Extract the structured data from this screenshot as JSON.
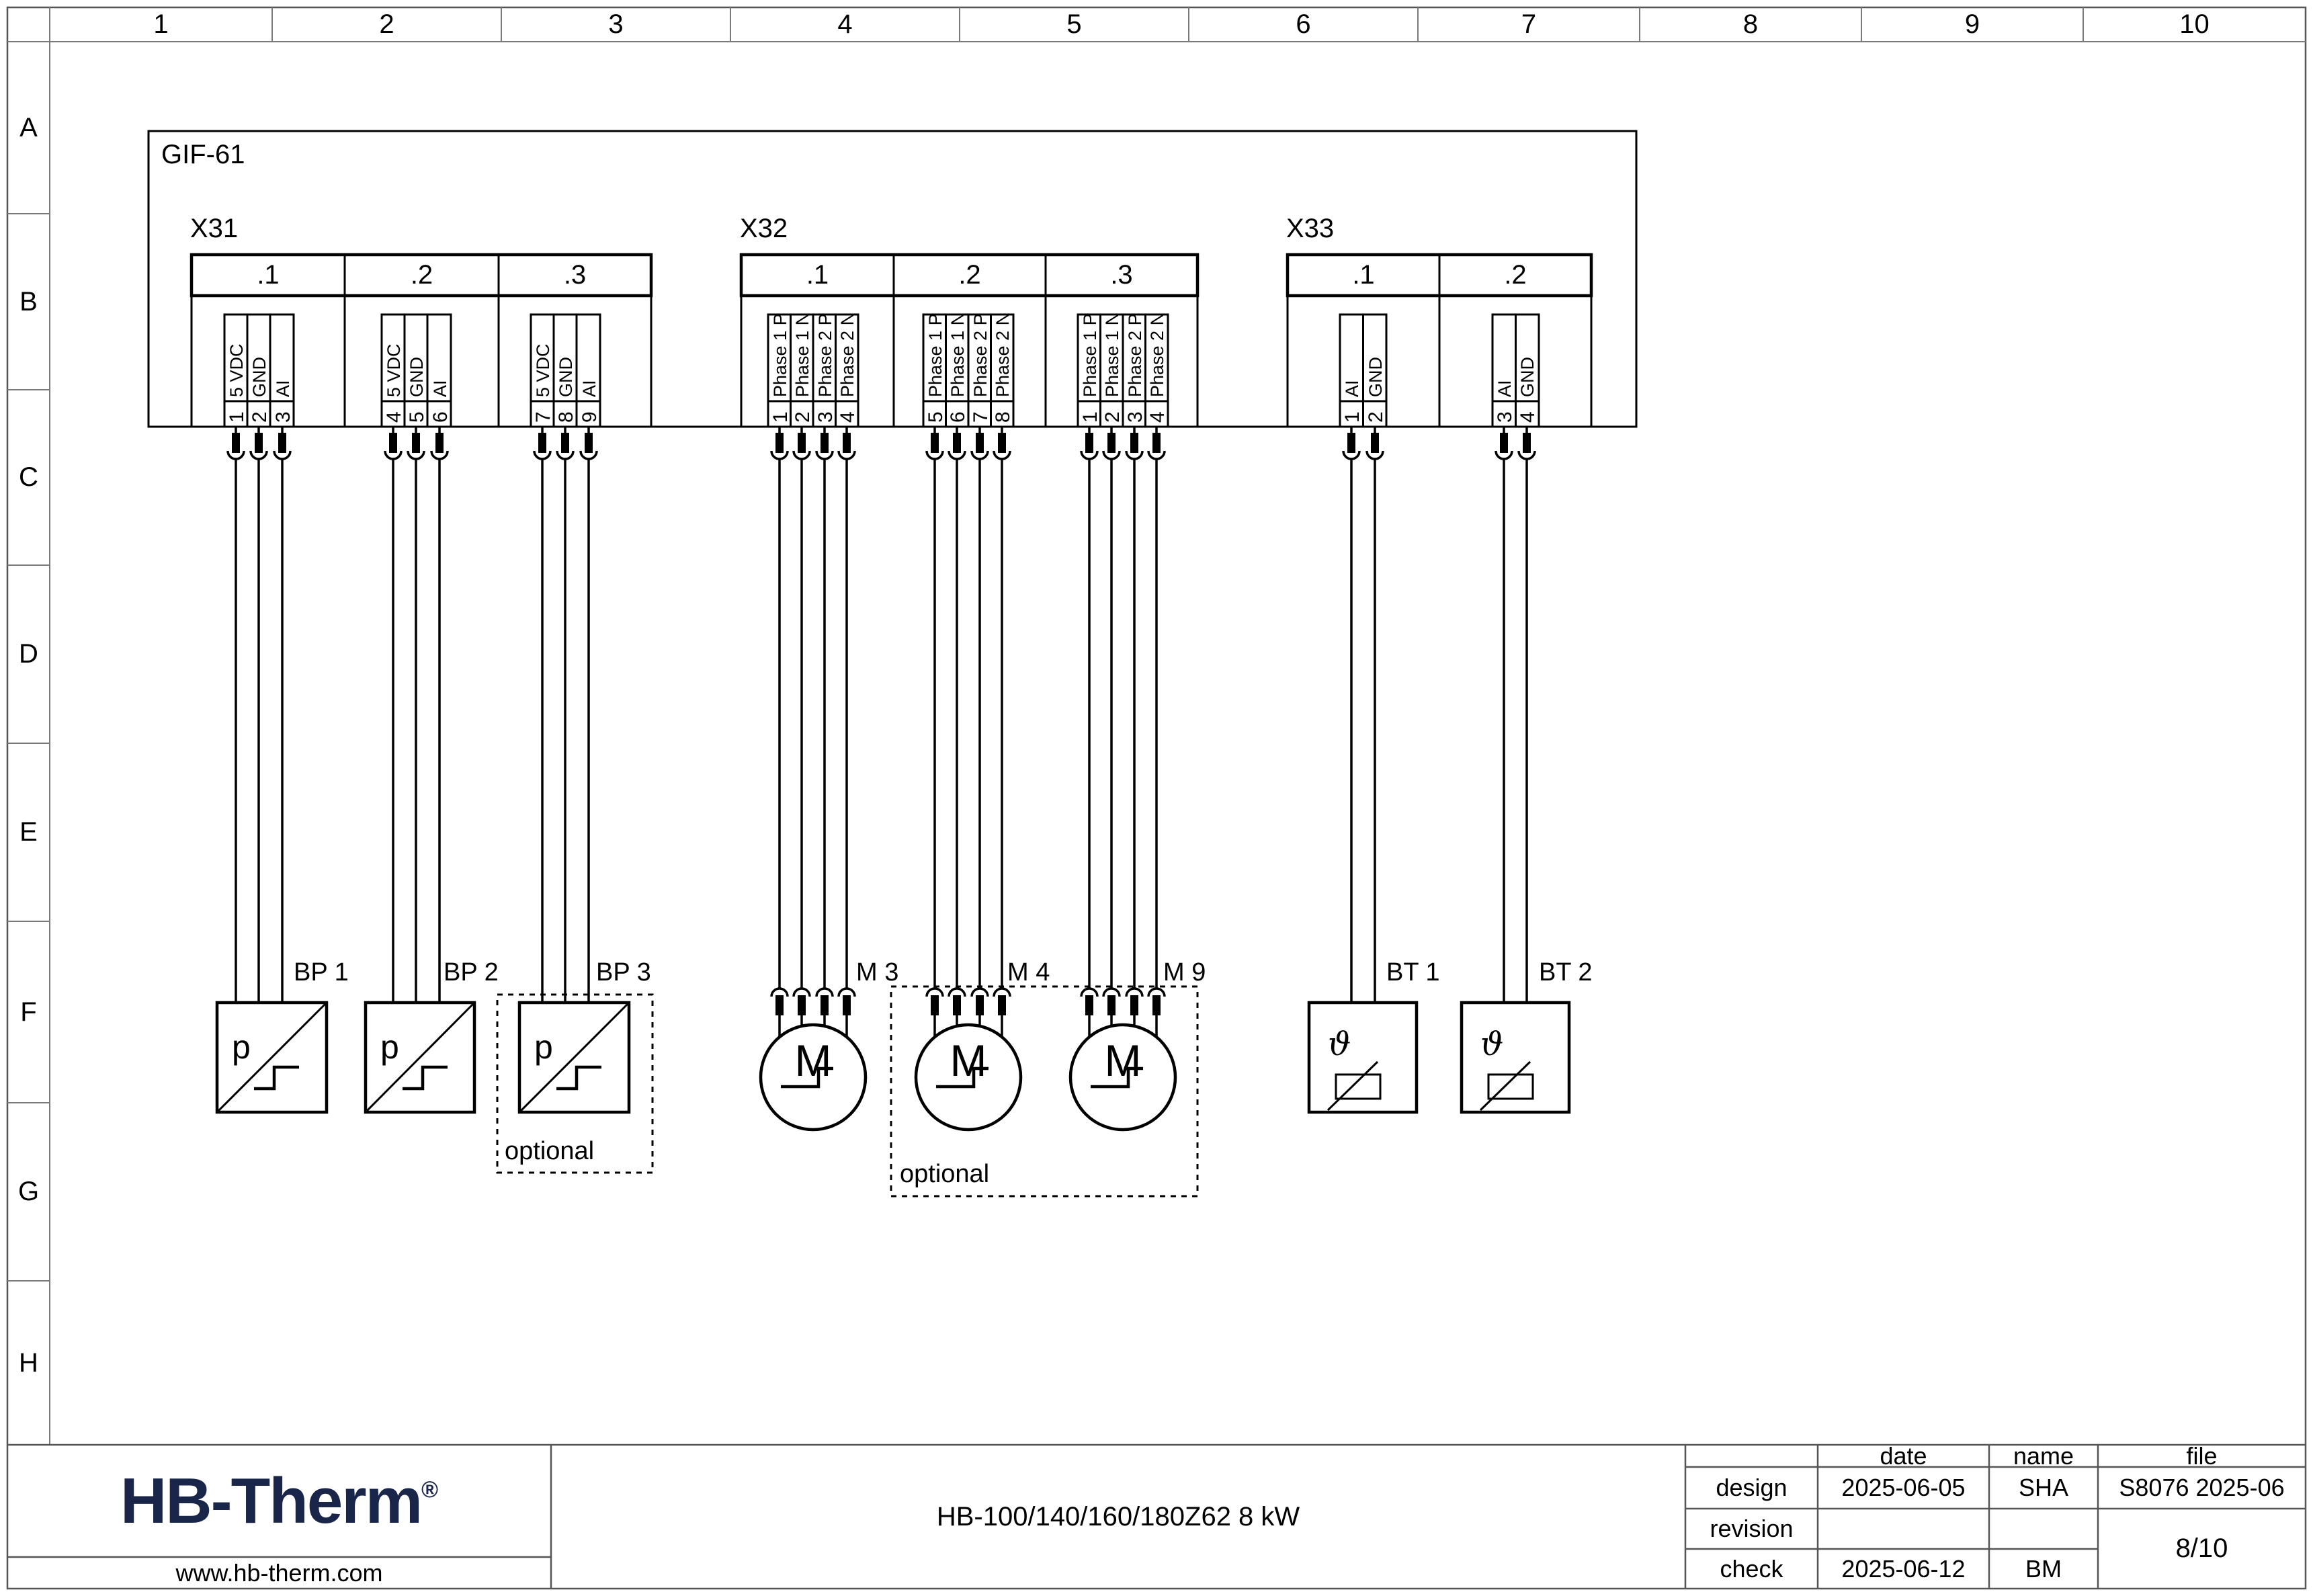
{
  "ruler": {
    "columns": [
      "1",
      "2",
      "3",
      "4",
      "5",
      "6",
      "7",
      "8",
      "9",
      "10"
    ],
    "rows": [
      "A",
      "B",
      "C",
      "D",
      "E",
      "F",
      "G",
      "H"
    ]
  },
  "diagram": {
    "unit_label": "GIF-61",
    "optional_label": "optional",
    "connectors": [
      {
        "id": "X31",
        "groups": [
          {
            "label": ".1",
            "pins": [
              {
                "n": "1",
                "sig": "5 VDC"
              },
              {
                "n": "2",
                "sig": "GND"
              },
              {
                "n": "3",
                "sig": "AI"
              }
            ]
          },
          {
            "label": ".2",
            "pins": [
              {
                "n": "4",
                "sig": "5 VDC"
              },
              {
                "n": "5",
                "sig": "GND"
              },
              {
                "n": "6",
                "sig": "AI"
              }
            ]
          },
          {
            "label": ".3",
            "pins": [
              {
                "n": "7",
                "sig": "5 VDC"
              },
              {
                "n": "8",
                "sig": "GND"
              },
              {
                "n": "9",
                "sig": "AI"
              }
            ]
          }
        ]
      },
      {
        "id": "X32",
        "groups": [
          {
            "label": ".1",
            "pins": [
              {
                "n": "1",
                "sig": "Phase 1 P"
              },
              {
                "n": "2",
                "sig": "Phase 1 N"
              },
              {
                "n": "3",
                "sig": "Phase 2 P"
              },
              {
                "n": "4",
                "sig": "Phase 2 N"
              }
            ]
          },
          {
            "label": ".2",
            "pins": [
              {
                "n": "5",
                "sig": "Phase 1 P"
              },
              {
                "n": "6",
                "sig": "Phase 1 N"
              },
              {
                "n": "7",
                "sig": "Phase 2 P"
              },
              {
                "n": "8",
                "sig": "Phase 2 N"
              }
            ]
          },
          {
            "label": ".3",
            "pins": [
              {
                "n": "1",
                "sig": "Phase 1 P"
              },
              {
                "n": "2",
                "sig": "Phase 1 N"
              },
              {
                "n": "3",
                "sig": "Phase 2 P"
              },
              {
                "n": "4",
                "sig": "Phase 2 N"
              }
            ]
          }
        ]
      },
      {
        "id": "X33",
        "groups": [
          {
            "label": ".1",
            "pins": [
              {
                "n": "1",
                "sig": "AI"
              },
              {
                "n": "2",
                "sig": "GND"
              }
            ]
          },
          {
            "label": ".2",
            "pins": [
              {
                "n": "3",
                "sig": "AI"
              },
              {
                "n": "4",
                "sig": "GND"
              }
            ]
          }
        ]
      }
    ],
    "devices": [
      {
        "label": "BP 1",
        "symbol": "p"
      },
      {
        "label": "BP 2",
        "symbol": "p"
      },
      {
        "label": "BP 3",
        "symbol": "p"
      },
      {
        "label": "M 3",
        "symbol": "M"
      },
      {
        "label": "M 4",
        "symbol": "M"
      },
      {
        "label": "M 9",
        "symbol": "M"
      },
      {
        "label": "BT 1",
        "symbol": "ϑ"
      },
      {
        "label": "BT 2",
        "symbol": "ϑ"
      }
    ]
  },
  "title_block": {
    "logo_text": "HB-Therm",
    "logo_reg": "®",
    "website": "www.hb-therm.com",
    "drawing_title": "HB-100/140/160/180Z62 8 kW",
    "logo_color": "#1a2649",
    "table": {
      "headers": {
        "date": "date",
        "name": "name",
        "file": "file"
      },
      "rows": [
        {
          "label": "design",
          "date": "2025-06-05",
          "name": "SHA",
          "file": "S8076 2025-06"
        },
        {
          "label": "revision",
          "date": "",
          "name": "",
          "file": ""
        },
        {
          "label": "check",
          "date": "2025-06-12",
          "name": "BM",
          "file": ""
        }
      ],
      "page_number": "8/10"
    }
  }
}
